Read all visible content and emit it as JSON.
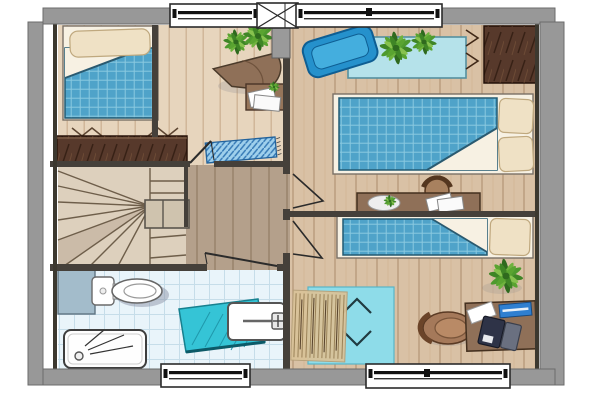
{
  "document": {
    "kind": "architectural-floor-plan",
    "view": "top-down-color-rendered",
    "visible_text": "none"
  },
  "palette": {
    "background": "#ffffff",
    "wall_exterior": "#989898",
    "wall_interior": "#45403a",
    "floor_wood_light": "#e7d5bd",
    "floor_wood_mid": "#d9c1a5",
    "floor_landing": "#b4a08b",
    "floor_tile": "#e9f4fa",
    "stairs": "#ddd0bd",
    "blanket_blue": "#4fa3c9",
    "pillow_cream": "#efe1c5",
    "rug_cyan": "#8edce9",
    "bath_mat_teal": "#35c4d6",
    "doormat_blue": "#9fd0ec",
    "chair_blue": "#2591cc",
    "table_light_blue": "#b5e2ea",
    "furniture_dark_brown": "#57392b",
    "furniture_mid_brown": "#8f7058",
    "plant_green": "#4e9a2e",
    "fixture_white": "#ffffff",
    "laptop_dark": "#2e3347",
    "book_blue": "#2f7fd0"
  },
  "rooms": [
    {
      "id": "bedroom-1",
      "position": "top-left",
      "furniture": [
        "single-bed",
        "pillow",
        "plaid-blanket",
        "chest-of-drawers",
        "folded-textile-symbols"
      ]
    },
    {
      "id": "study-nook",
      "position": "top-center",
      "furniture": [
        "potted-plant",
        "corner-desk",
        "side-table",
        "papers",
        "small-plant",
        "doormat"
      ]
    },
    {
      "id": "bedroom-2",
      "position": "right",
      "furniture": [
        "blue-lounge-chair",
        "light-blue-console-table",
        "potted-plant",
        "wardrobe",
        "hanging-symbols",
        "double-bed",
        "two-pillows",
        "writing-desk",
        "stool",
        "plate",
        "papers"
      ]
    },
    {
      "id": "bedroom-3",
      "position": "bottom-right",
      "furniture": [
        "single-bed",
        "pillow",
        "potted-plant",
        "area-rug",
        "fringed-throw",
        "desk",
        "chair",
        "laptop",
        "blue-book",
        "paper"
      ]
    },
    {
      "id": "stair-landing",
      "position": "center-left",
      "furniture": [
        "winder-staircase",
        "newel-handrail"
      ]
    },
    {
      "id": "bathroom",
      "position": "bottom-left",
      "furniture": [
        "cistern-cabinet",
        "toilet",
        "shower-tray",
        "bath-mat",
        "washbasin-with-tap"
      ]
    }
  ],
  "openings": {
    "top_windows": 2,
    "bottom_windows": 2,
    "chimney_flue_boxes": 1,
    "interior_door_openings": 4
  }
}
